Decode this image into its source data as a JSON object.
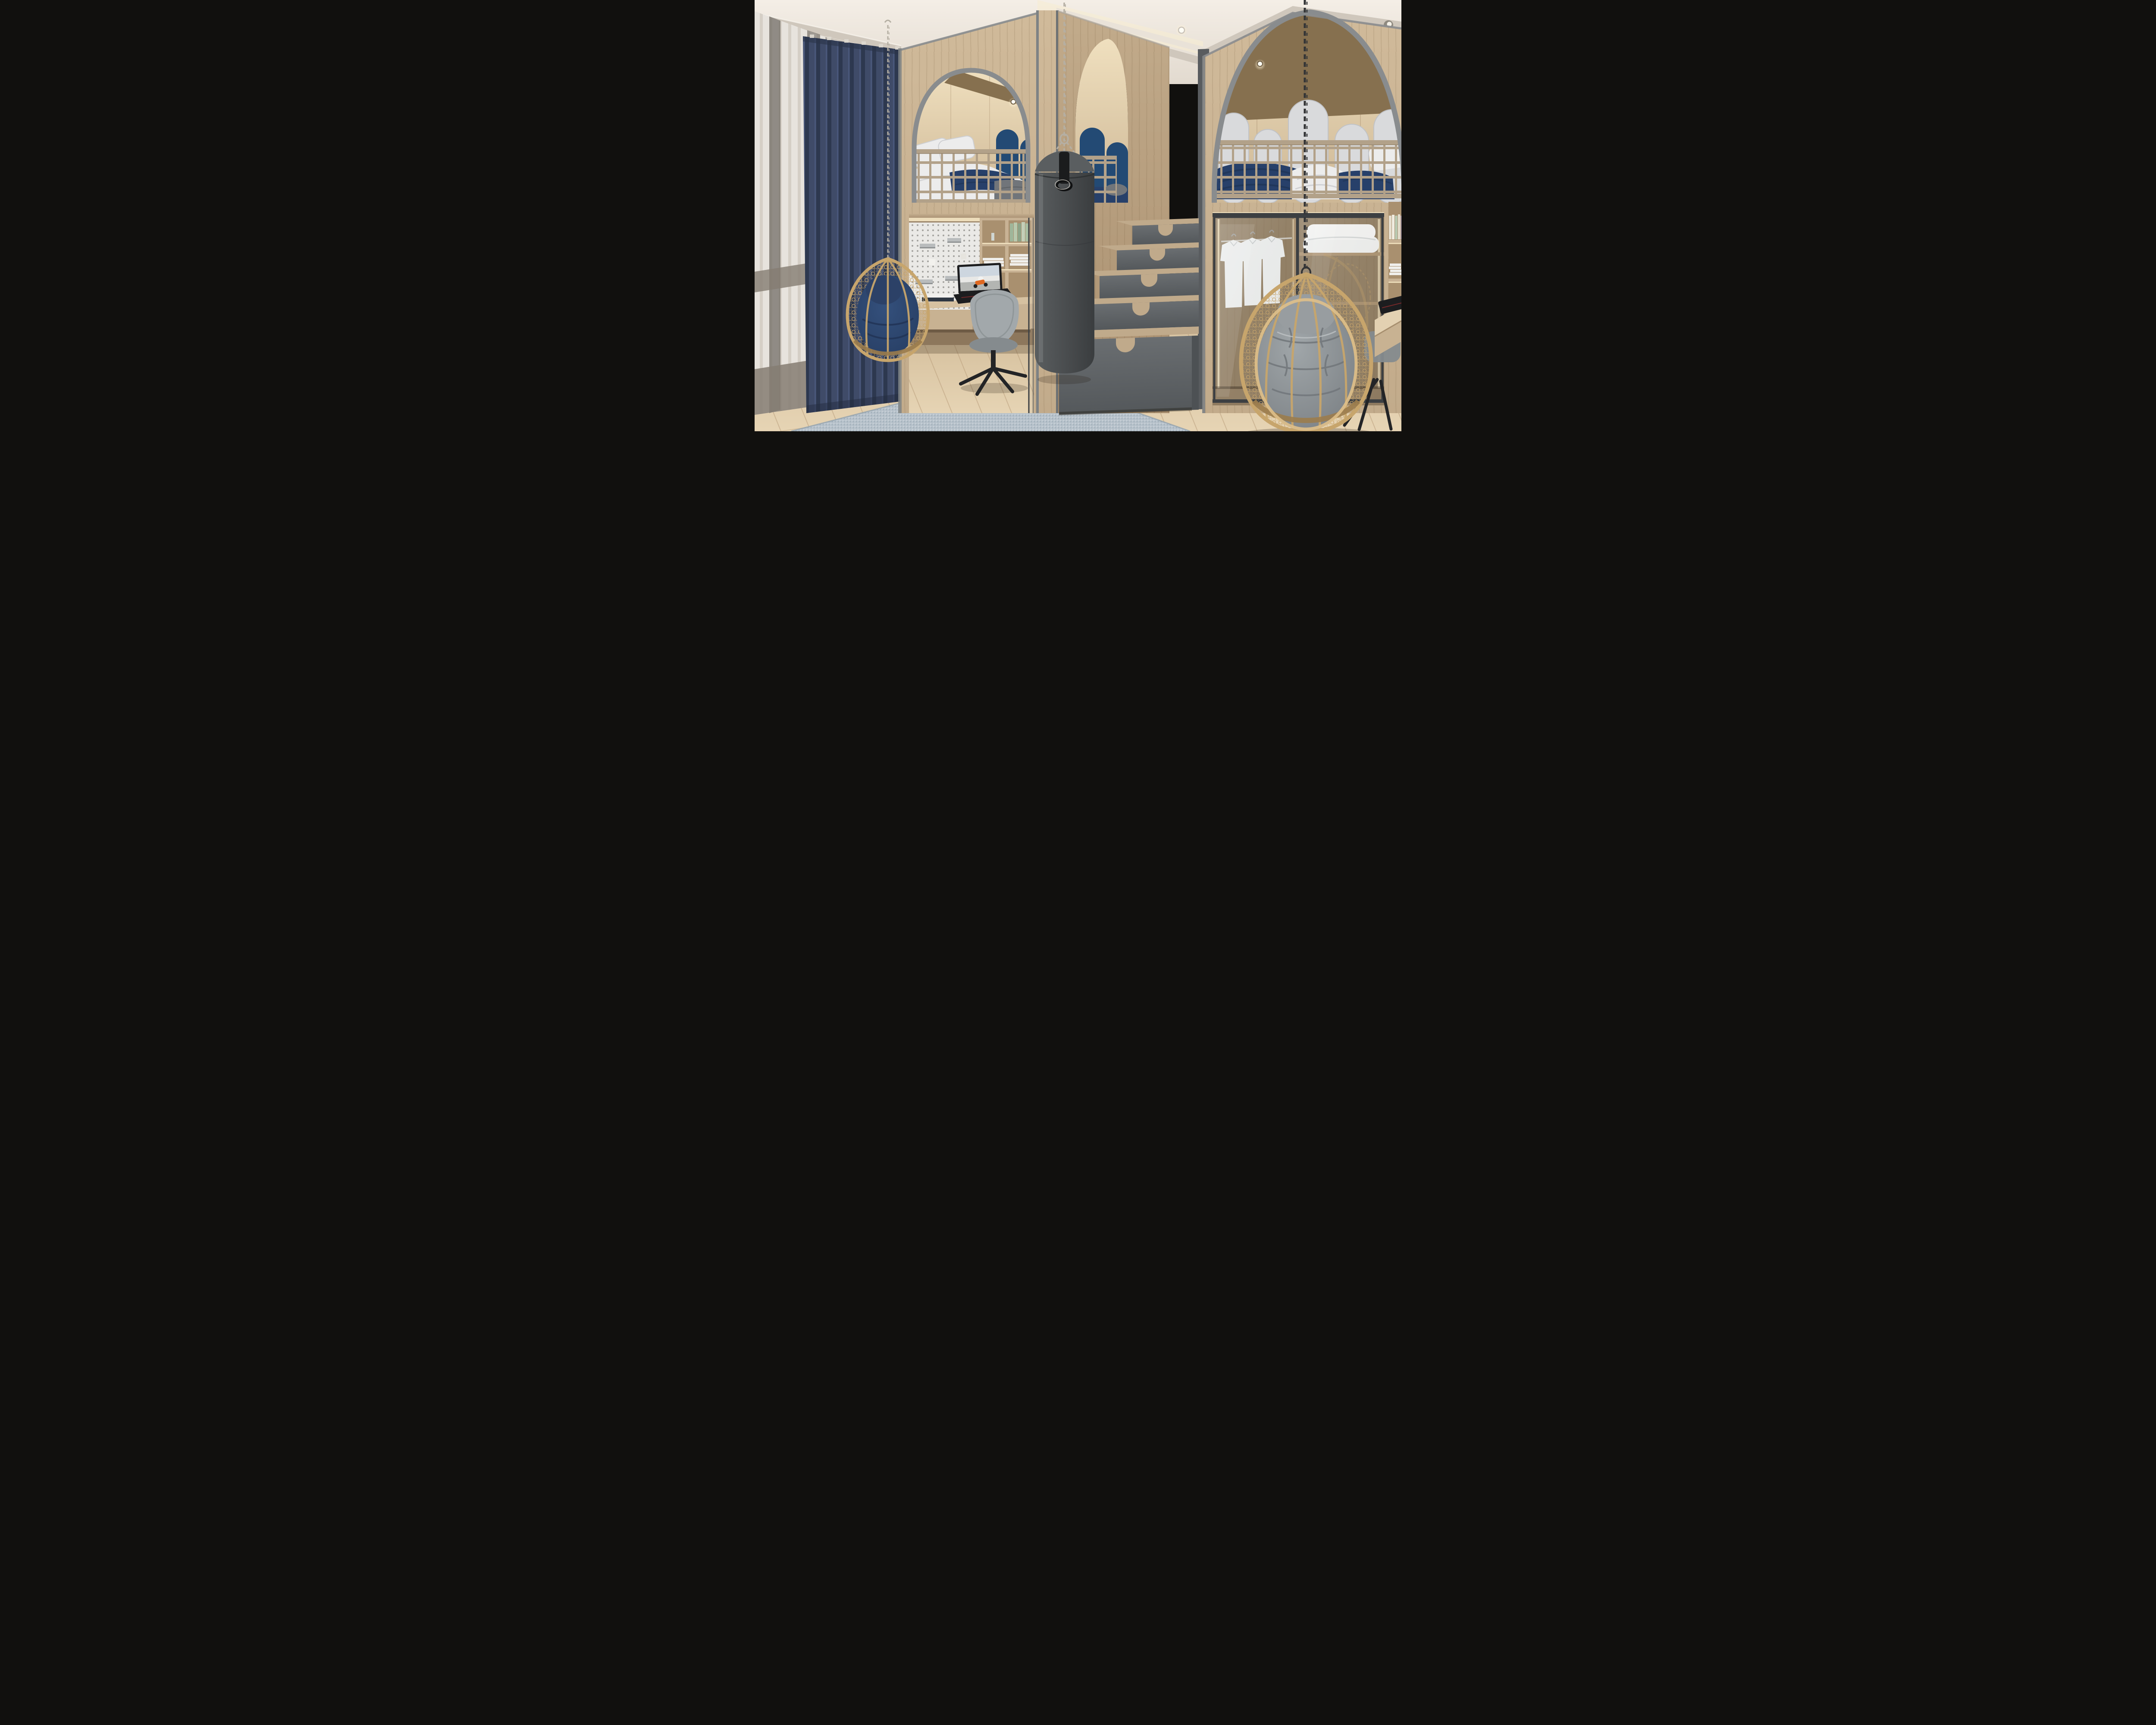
{
  "meta": {
    "description": "Photorealistic 3D interior rendering of a children's bedroom with two arched wooden loft beds, a study nook, storage staircase, punching bag and two hanging rattan chairs",
    "render_style": "architectural visualization, no visible text"
  },
  "palette": {
    "ceiling_a": "#f4eee6",
    "ceiling_b": "#e2dacf",
    "molding": "#cfc7bc",
    "molding_dark": "#aaa399",
    "cove_glow": "#f7ecd2",
    "wood_light": "#d0ba9a",
    "wood_mid": "#c2ab8b",
    "wood_dark": "#a98f6f",
    "soffit_wood": "#86704f",
    "arch_frame": "#898c8e",
    "trim_gray": "#7e8284",
    "sheer_light": "#e7e3dd",
    "sheer_shade": "#d5cfc6",
    "sheer_band": "#857c72",
    "sheer_stripe": "#6f6962",
    "navy_curtain": "#3f4b68",
    "navy_curtain_dark": "#2d384f",
    "headboard_navy": "#234a74",
    "panel_white": "#d9dadc",
    "panel_white_shade": "#c0c2c6",
    "bed_white": "#ececec",
    "bed_white_shade": "#cdced1",
    "bedding_navy": "#27406a",
    "knit_navy": "#1f3557",
    "bedding_gray": "#71757a",
    "railing": "#b2a189",
    "railing_dark": "#93836c",
    "pegboard": "#eae9e6",
    "peg_hole": "#a3a29e",
    "metal_shelf": "#b9bcbd",
    "shelf_wood": "#c8b294",
    "shelf_interior": "#a9906f",
    "desk_wood": "#d6c1a1",
    "desk_front": "#c8b292",
    "chair_gray": "#a2a8ab",
    "chair_gray_dark": "#858b8e",
    "black": "#232426",
    "rattan": "#c7a56c",
    "rattan_light": "#dfc08a",
    "rattan_dark": "#9b7c4d",
    "cushion_navy": "#2c4167",
    "cushion_navy_dark": "#203254",
    "cushion_gray": "#8f9396",
    "cushion_gray_dark": "#71767a",
    "bag_gray": "#4c4f51",
    "bag_dark": "#3a3d3f",
    "bag_top": "#5a5e60",
    "chain_light": "#b5afa3",
    "chain_black": "#333436",
    "stair_front": "#606467",
    "stair_front_dark": "#4d5154",
    "stair_tread": "#c0aa8b",
    "glass_frame": "#3c3f42",
    "shirt_white": "#eceff0",
    "paper": "#f0efec",
    "book_green": "#b9c8b0",
    "book_pink": "#d9c6d0",
    "book_cream": "#e6e0d0",
    "led_warm": "#f6e7c4",
    "floor_a": "#d7c2a0",
    "floor_b": "#e6d4b4",
    "plank_line": "#b99f7c",
    "rug_base": "#b7c2cb",
    "rug_dark": "#93a2ae",
    "rug_light": "#d4dadf",
    "laptop_black": "#1c1d1f",
    "screen_sky": "#cdd6df",
    "moto_orange": "#e06820"
  },
  "scene": {
    "ceiling": {
      "label": "white ceiling with crown molding, cove light and recessed spotlights",
      "spotlights": 3
    },
    "window": {
      "sheer": {
        "label": "white sheer curtain with taupe horizontal bands and two dark vertical stripes"
      },
      "blue": {
        "label": "navy blue floor-length curtain with vertical wave folds"
      }
    },
    "left_loft": {
      "label": "left loft bed inside arched wooden alcove with gray arch frame",
      "bed": {
        "label": "loft mattress with white pillows, white duvet, navy throw and gray blanket"
      },
      "headboards": {
        "label": "navy arched upholstered headboard panels",
        "count": 2
      },
      "railing": {
        "label": "wooden grid guard railing"
      },
      "light": {
        "label": "recessed warm spotlight under wood soffit"
      }
    },
    "desk_nook": {
      "label": "study nook under left loft",
      "pegboard": {
        "label": "white perforated pegboard with gray metal ledges",
        "ledges": 4
      },
      "shelving": {
        "label": "wooden cubby shelves with green books and white book stacks"
      },
      "desk": {
        "label": "floating oak desk with two drawers",
        "drawers": 2
      },
      "laptop": {
        "label": "open gaming laptop, screen showing an orange racing motorcycle"
      },
      "books": {
        "label": "stack of books on the desk"
      },
      "chair": {
        "label": "gray upholstered swivel desk chair with black four-spoke base"
      },
      "glass": {
        "label": "dark framed glass partition"
      }
    },
    "hanging_chair_left": {
      "label": "rattan egg swing chair with navy cushion hanging from light chain",
      "cushion": "navy"
    },
    "punching_bag": {
      "label": "dark gray fabric punching bag hanging on chains from the ceiling",
      "chains": 3,
      "ring": "black strap with metal D-ring"
    },
    "middle_arch": {
      "label": "second arched opening revealing navy headboards and bed of the left loft"
    },
    "staircase": {
      "label": "storage staircase to the loft with gray drawer fronts and oak treads",
      "steps": 4,
      "drawers": 5,
      "bottom_drawer": {
        "label": "wide storage drawer at the base"
      }
    },
    "right_loft": {
      "label": "large right loft bed behind a wide gray framed arch",
      "headboard_panels": {
        "label": "row of white arched headboard panels",
        "count": 5
      },
      "bed": {
        "label": "navy chunky knit blanket, white duvet, navy duvet and white pillows"
      },
      "railing": {
        "label": "wooden grid guard railing"
      },
      "soffit_lights": 2
    },
    "wardrobe": {
      "label": "built-in wardrobe with sliding glass doors under the right loft",
      "shirts": {
        "label": "three white shirts on hangers",
        "count": 3
      },
      "duvet_shelf": {
        "label": "folded white duvet on upper shelf"
      },
      "lighting": {
        "label": "vertical warm LED strips"
      }
    },
    "hanging_chair_right": {
      "label": "large rattan egg swing chair with tufted gray cushion on a black chain",
      "cushion": "gray"
    },
    "bookshelf_right": {
      "label": "wooden bookshelf at right edge with pastel book spines and white magazines",
      "books": 5
    },
    "right_desk": {
      "label": "oak desk at right edge with black laptop"
    },
    "office_chair_right": {
      "label": "dark office chair partially hidden behind the swing chair"
    },
    "rug": {
      "label": "light blue-gray woven area rug laid diagonally"
    },
    "floor": {
      "label": "light oak plank floor laid diagonally"
    }
  }
}
